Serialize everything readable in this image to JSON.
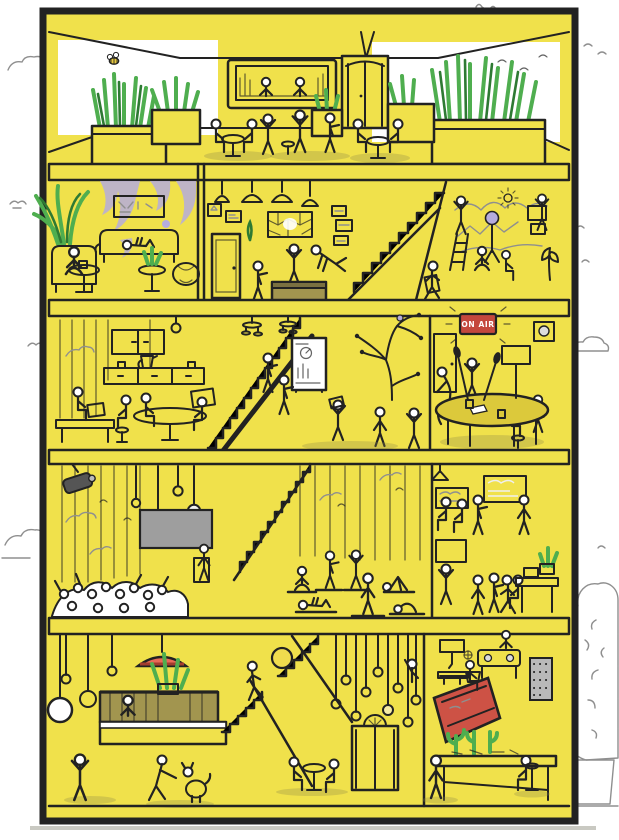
{
  "signs": {
    "on_air": "ON AIR"
  },
  "colors": {
    "yellow": "#F0E14B",
    "yellow_dark": "#DCC93B",
    "outline": "#222222",
    "green": "#4FAE4F",
    "green_dark": "#2E7A33",
    "purple": "#B5ACDC",
    "red": "#C4483D",
    "coral": "#E86A57",
    "olive": "#A2954F",
    "gray": "#9E9E9E",
    "gray_light": "#C9C9C9",
    "bulb_glow": "#F6ECA4",
    "sketch": "#8f8f8f",
    "shadow": "#8f874a"
  },
  "scene": {
    "type": "building-cutaway-illustration",
    "floors": [
      {
        "name": "rooftop-lounge",
        "rooms": [
          "rooftop-bar",
          "planter-gardens",
          "elevator"
        ]
      },
      {
        "name": "second-floor",
        "rooms": [
          "reading-lounge",
          "meeting-room",
          "staircase",
          "art-studio"
        ]
      },
      {
        "name": "third-floor",
        "rooms": [
          "office-kitchenette",
          "staircase",
          "brainstorm-area",
          "podcast-studio"
        ]
      },
      {
        "name": "fourth-floor",
        "rooms": [
          "auditorium",
          "staircase",
          "yoga-room",
          "screens-lab"
        ]
      },
      {
        "name": "ground-floor",
        "rooms": [
          "reception-bar",
          "staircase",
          "elevator-lobby",
          "workshop"
        ]
      }
    ]
  }
}
